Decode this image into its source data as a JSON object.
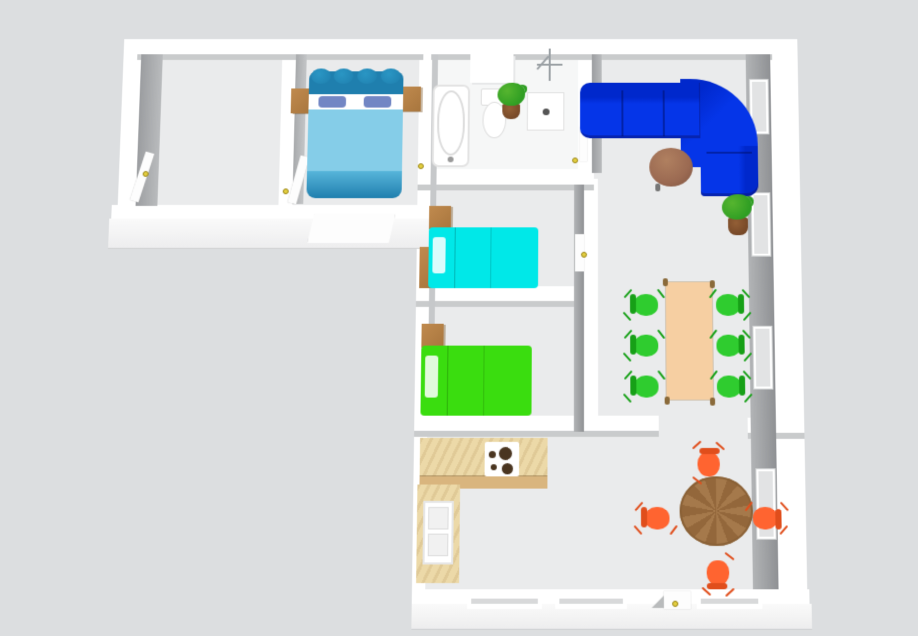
{
  "app": {
    "name": "3D floor plan overhead view"
  },
  "palette": {
    "bg_gray": "#dcdee0",
    "wall_white": "#ffffff",
    "floor_gray": "#eaebec",
    "floor_bath": "#f6f7f7",
    "handle_yellow": "#e3cf3f",
    "wood_light": "#c08a4e",
    "counter_front": "#d9b57e",
    "master_bed_body": "#85cde8",
    "master_bed_trim": "#1f7fae",
    "master_bed_pillow": "#7286c4",
    "cyan_bed": "#00e8e8",
    "green_bed": "#3add0f",
    "sofa_blue": "#0535e8",
    "sofa_blue_dark": "#0028cc",
    "coffee_brown": "#9b6a52",
    "dining_tan": "#f6cfa2",
    "chair_green": "#2fcc2f",
    "chair_green_dark": "#17a017",
    "chair_orange": "#ff6430",
    "chair_orange_dark": "#e04e1c",
    "round_wood": "#a5794b",
    "plant_green": "#2f9e23",
    "plant_pot": "#6b3f22"
  },
  "scene": {
    "rooms": [
      {
        "name": "empty room",
        "furniture": []
      },
      {
        "name": "master bedroom",
        "furniture": [
          "double bed (blue)",
          "nightstand",
          "nightstand"
        ]
      },
      {
        "name": "bathroom",
        "furniture": [
          "bathtub",
          "toilet",
          "wall cabinet",
          "shower base",
          "towel stand",
          "potted plant"
        ]
      },
      {
        "name": "small bedroom cyan",
        "furniture": [
          "single bed (cyan)",
          "nightstand",
          "dresser"
        ]
      },
      {
        "name": "small bedroom green",
        "furniture": [
          "single bed (green)",
          "nightstand"
        ]
      },
      {
        "name": "kitchen",
        "furniture": [
          "L-shaped counter",
          "cooktop",
          "sink"
        ]
      },
      {
        "name": "living room",
        "furniture": [
          "corner sofa (blue)",
          "round coffee table",
          "potted plant"
        ]
      },
      {
        "name": "dining area",
        "furniture": [
          "rectangular dining table",
          "green chair x6"
        ]
      },
      {
        "name": "breakfast area",
        "furniture": [
          "round wooden table",
          "orange chair x4"
        ]
      }
    ],
    "doors": [
      "empty room door",
      "master bedroom door",
      "open exterior door (south of master bedroom)",
      "bathroom door",
      "hallway door (central divider)",
      "south wall entrance door"
    ],
    "windows": {
      "east_wall": 4,
      "south_wall": 3
    },
    "door_handle_count": 6
  }
}
